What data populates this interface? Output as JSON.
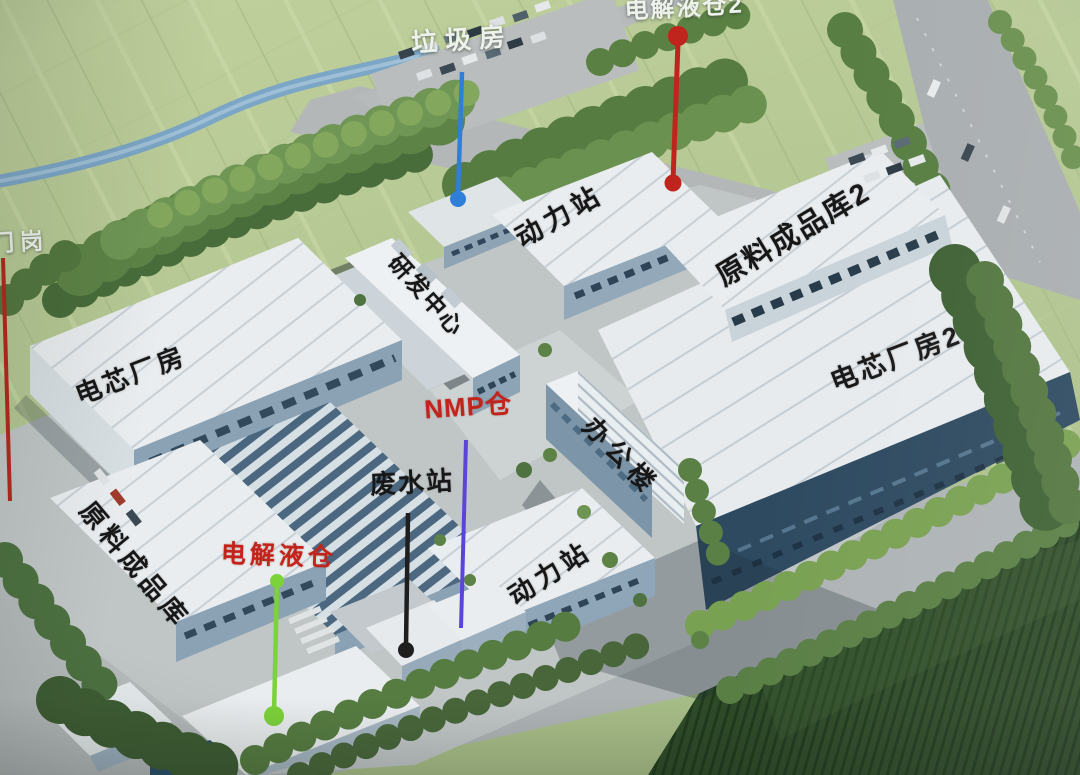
{
  "labels": {
    "gate": "门岗",
    "garbage_room": "垃圾房",
    "electrolyte_warehouse_2": "电解液仓2",
    "power_station_north": "动力站",
    "rnd_center": "研发中心",
    "raw_material_finished_goods_warehouse_2": "原料成品库2",
    "cell_plant_1": "电芯厂房",
    "cell_plant_2": "电芯厂房2",
    "nmp_warehouse": "NMP仓",
    "office_building": "办公楼",
    "wastewater_station": "废水站",
    "raw_material_finished_goods_warehouse_1": "原料成品库",
    "electrolyte_warehouse_1": "电解液仓",
    "power_station_south": "动力站"
  },
  "pins": {
    "garbage_room": {
      "color": "#2f7fd8"
    },
    "electrolyte_warehouse_2": {
      "color": "#c0251d"
    },
    "west_boundary": {
      "color": "#b4281e"
    },
    "electrolyte_warehouse_1": {
      "color": "#7cd23a"
    },
    "nmp_warehouse": {
      "color": "#5b45d8"
    },
    "wastewater_station": {
      "color": "#1e1e1e"
    }
  },
  "label_colors": {
    "dark": "#171717",
    "light": "#eef2ec",
    "red": "#c2231a"
  }
}
